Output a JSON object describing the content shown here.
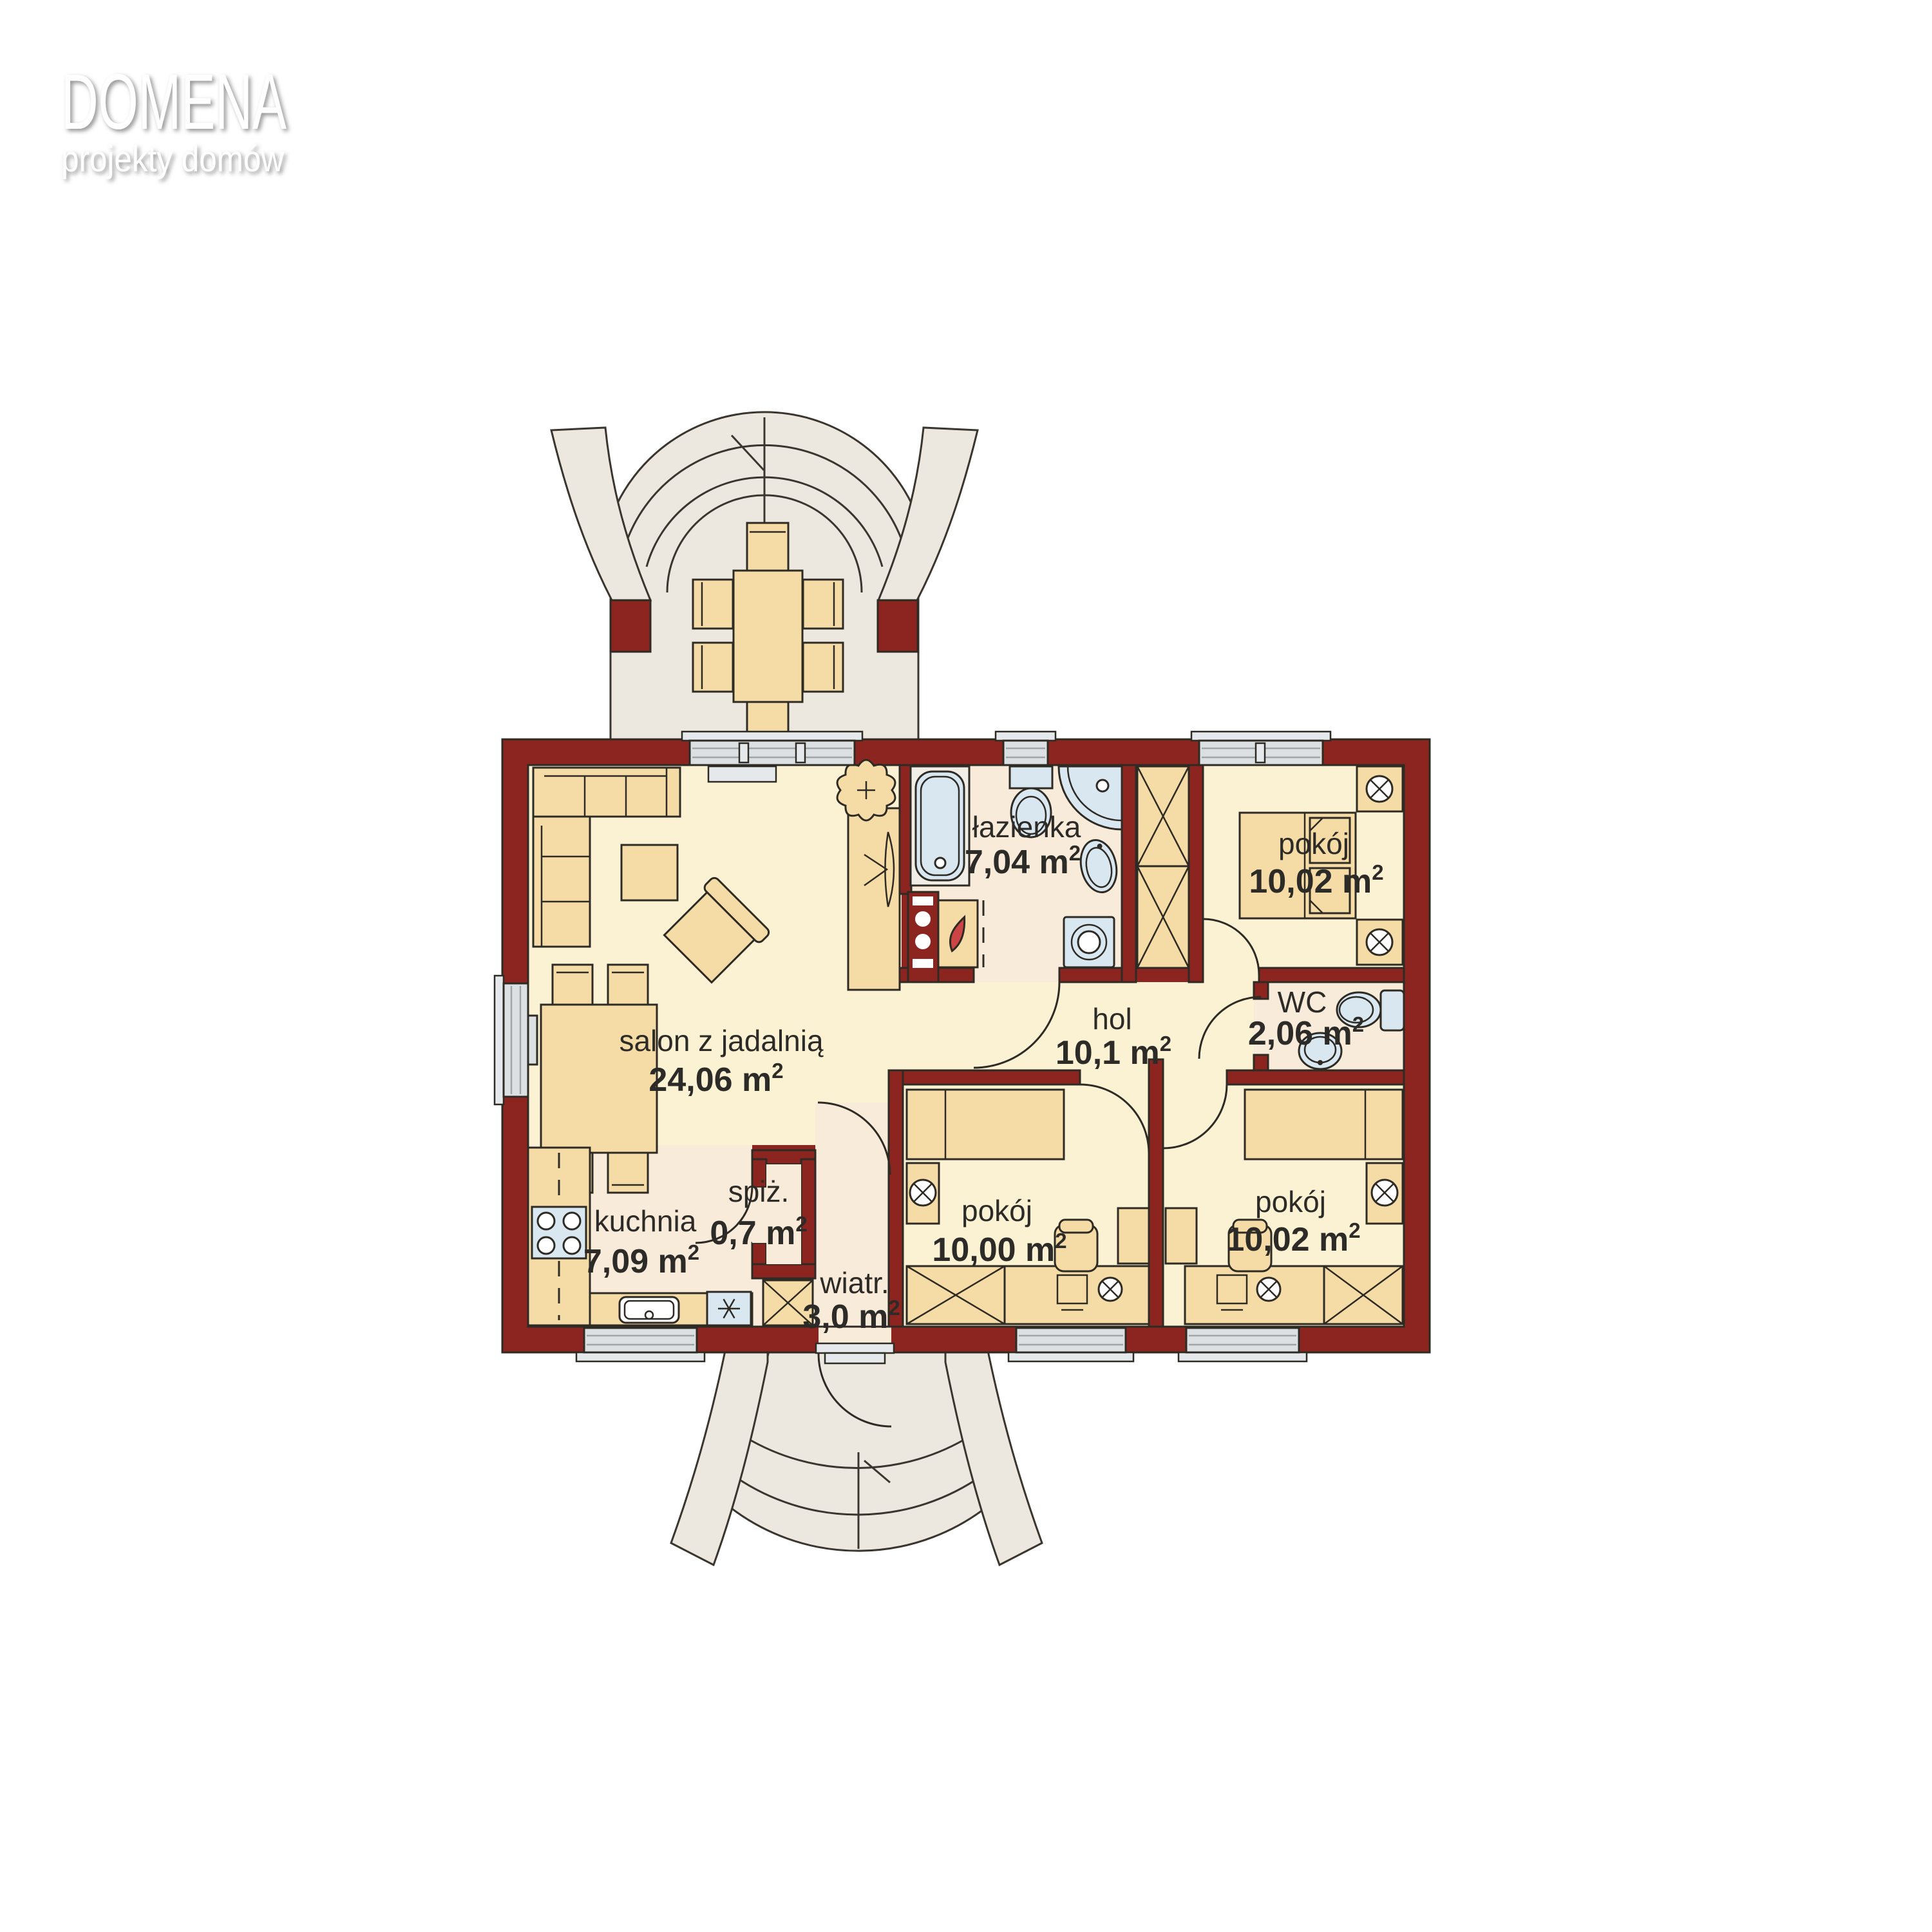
{
  "logo": {
    "title": "DOMENA",
    "subtitle": "projekty domów"
  },
  "unit_sup": "2",
  "rooms": [
    {
      "id": "salon",
      "name": "salon z jadalnią",
      "area": "24,06 m"
    },
    {
      "id": "kuchnia",
      "name": "kuchnia",
      "area": "7,09 m"
    },
    {
      "id": "spizarnia",
      "name": "spiż.",
      "area": "0,7 m"
    },
    {
      "id": "wiatrolap",
      "name": "wiatr.",
      "area": "3,0 m"
    },
    {
      "id": "lazienka",
      "name": "łazienka",
      "area": "7,04 m"
    },
    {
      "id": "hol",
      "name": "hol",
      "area": "10,1 m"
    },
    {
      "id": "wc",
      "name": "WC",
      "area": "2,06 m"
    },
    {
      "id": "pokoj-gorny-prawy",
      "name": "pokój",
      "area": "10,02 m"
    },
    {
      "id": "pokoj-dolny-srodkowy",
      "name": "pokój",
      "area": "10,00 m"
    },
    {
      "id": "pokoj-dolny-prawy",
      "name": "pokój",
      "area": "10,02 m"
    }
  ],
  "colors": {
    "wall": "#8C2420",
    "outline": "#2E2A24",
    "floor_yellow": "#FBF1D3",
    "floor_pink": "#F8EBDA",
    "furniture": "#F5DCA6",
    "fixture": "#D9E7F0",
    "tub_rim": "#F0EEE6",
    "terrace": "#ECE8DF",
    "terrace_line": "#3A362F",
    "window": "#DCE0E3",
    "window_sill": "#E6E9EB",
    "window_line": "#9FA5A9",
    "flame": "#CC4444",
    "label": "#2D2B27",
    "logo": "#FEFEFE",
    "logo_shadow": "#989898"
  }
}
